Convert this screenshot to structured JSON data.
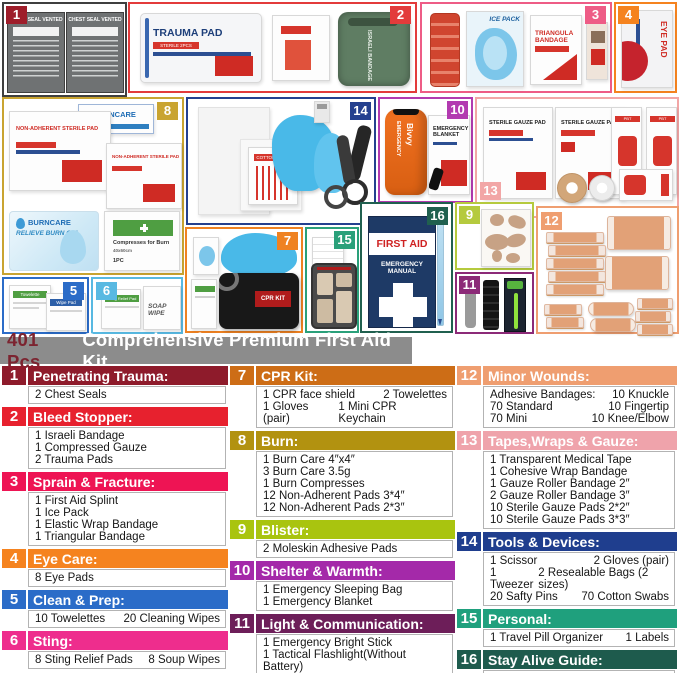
{
  "title": {
    "prefix": "401 Pcs",
    "rest": "Comprehensive Premium First Aid Kit"
  },
  "collage": {
    "box_colors": {
      "b1": "#9e1d2a",
      "b2": "#e33b3b",
      "b3": "#ee5c86",
      "b4": "#f5831f",
      "b5": "#2b6cc8",
      "b6": "#58b9e2",
      "b7": "#ef8222",
      "b8": "#c9a431",
      "b9": "#b5ca3e",
      "b10": "#b23ab0",
      "b11": "#8c2a78",
      "b12": "#ef9e70",
      "b13": "#f2a6a6",
      "b14": "#24408f",
      "b15": "#2aa07a",
      "b16": "#20604f"
    },
    "badges": [
      "1",
      "2",
      "3",
      "4",
      "5",
      "6",
      "7",
      "8",
      "9",
      "10",
      "11",
      "12",
      "13",
      "14",
      "15",
      "16"
    ],
    "labels": {
      "chest_seal": "CHEST SEAL VENTED",
      "trauma_pad": "TRAUMA PAD",
      "trauma_pad_sub": "STERILE 2PCS",
      "israeli": "ISRAELI BANDAGE",
      "ice_pack": "ICE PACK",
      "triangula": "TRIANGULA BANDAGE",
      "eye_pad": "EYE PAD",
      "burncare": "BURNCARE",
      "burn_gel": "RELIEVE BURN GEL",
      "non_adherent": "NON-ADHERENT STERILE PAD",
      "compresses": "Compresses for Burn",
      "compresses_size": "40x60cm",
      "compresses_qty": "1PC",
      "cotton_swab": "COTTON SWAB",
      "bivvy_top": "EMERGENCY",
      "bivvy": "Bivvy",
      "blanket": "EMERGENCY BLANKET",
      "sterile_gauze": "STERILE GAUZE PAD",
      "pbt": "PBT BANDAGE",
      "cpr_kit": "CPR KIT",
      "first_aid": "FIRST AID",
      "manual": "EMERGENCY MANUAL",
      "towelette": "Towelette",
      "wipe_pad": "Wipe Pad",
      "sting_relief": "Sting Relief Pad",
      "soap_wipe": "SOAP WIPE"
    }
  },
  "legend": {
    "entries": [
      {
        "num": "1",
        "color": "#8e1b2b",
        "title": "Penetrating Trauma:",
        "items": [
          [
            "2 Chest Seals"
          ]
        ]
      },
      {
        "num": "2",
        "color": "#e7212e",
        "title": "Bleed Stopper:",
        "items": [
          [
            "1 Israeli Bandage"
          ],
          [
            "1 Compressed Gauze"
          ],
          [
            "2 Trauma Pads"
          ]
        ]
      },
      {
        "num": "3",
        "color": "#ee1454",
        "title": "Sprain & Fracture:",
        "items": [
          [
            "1 First Aid Splint"
          ],
          [
            "1 Ice Pack"
          ],
          [
            "1 Elastic Wrap Bandage"
          ],
          [
            "1 Triangular Bandage"
          ]
        ]
      },
      {
        "num": "4",
        "color": "#f5831f",
        "title": "Eye Care:",
        "items": [
          [
            "8 Eye Pads"
          ]
        ]
      },
      {
        "num": "5",
        "color": "#2b6cc8",
        "title": "Clean & Prep:",
        "items": [
          [
            "10 Towelettes",
            "20 Cleaning Wipes"
          ]
        ]
      },
      {
        "num": "6",
        "color": "#ee2d8d",
        "title": "Sting:",
        "items": [
          [
            "8 Sting Relief Pads",
            "8 Soup Wipes"
          ]
        ]
      },
      {
        "num": "7",
        "color": "#cd6d16",
        "title": "CPR Kit:",
        "items": [
          [
            "1 CPR face shield",
            "2 Towelettes"
          ],
          [
            "1 Gloves (pair)",
            "1 Mini CPR Keychain"
          ]
        ]
      },
      {
        "num": "8",
        "color": "#b29210",
        "title": "Burn:",
        "items": [
          [
            "1 Burn Care 4″x4″"
          ],
          [
            "3 Burn Care 3.5g"
          ],
          [
            "1 Burn Compresses"
          ],
          [
            "12 Non-Adherent Pads 3*4″"
          ],
          [
            "12 Non-Adherent Pads 2*3″"
          ]
        ]
      },
      {
        "num": "9",
        "color": "#a9c40f",
        "title": "Blister:",
        "items": [
          [
            "2 Moleskin Adhesive Pads"
          ]
        ]
      },
      {
        "num": "10",
        "color": "#a429a9",
        "title": "Shelter & Warmth:",
        "items": [
          [
            "1 Emergency Sleeping Bag"
          ],
          [
            "1 Emergency Blanket"
          ]
        ]
      },
      {
        "num": "11",
        "color": "#6d1e59",
        "title": "Light & Communication:",
        "items": [
          [
            "1 Emergency Bright Stick"
          ],
          [
            "1 Tactical Flashlight(Without Battery)"
          ],
          [
            "1 Survival Whistle"
          ]
        ]
      },
      {
        "num": "12",
        "color": "#ef9e70",
        "title": "Minor Wounds:",
        "items": [
          [
            "Adhesive Bandages:",
            "10 Knuckle"
          ],
          [
            "70 Standard",
            "10 Fingertip"
          ],
          [
            "70 Mini",
            "10 Knee/Elbow"
          ]
        ]
      },
      {
        "num": "13",
        "color": "#efa3ab",
        "title": "Tapes,Wraps & Gauze:",
        "items": [
          [
            "1 Transparent Medical Tape"
          ],
          [
            "1 Cohesive Wrap Bandage"
          ],
          [
            "1 Gauze Roller Bandage 2″"
          ],
          [
            "2 Gauze Roller Bandage 3″"
          ],
          [
            "10 Sterile Gauze Pads 2*2″"
          ],
          [
            "10 Sterile Gauze Pads 3*3″"
          ]
        ]
      },
      {
        "num": "14",
        "color": "#1f3e8e",
        "title": "Tools & Devices:",
        "items": [
          [
            "1 Scissor",
            "2 Gloves (pair)"
          ],
          [
            "1 Tweezer",
            "2 Resealable Bags (2 sizes)"
          ],
          [
            "20 Safty Pins",
            "70 Cotton Swabs"
          ]
        ]
      },
      {
        "num": "15",
        "color": "#1fa07d",
        "title": "Personal:",
        "items": [
          [
            "1 Travel Pill Organizer",
            "1 Labels"
          ]
        ]
      },
      {
        "num": "16",
        "color": "#1e5b4d",
        "title": "Stay Alive Guide:",
        "items": [
          [
            "1 First Aid Handbook",
            "1 Pencli"
          ]
        ]
      }
    ]
  }
}
